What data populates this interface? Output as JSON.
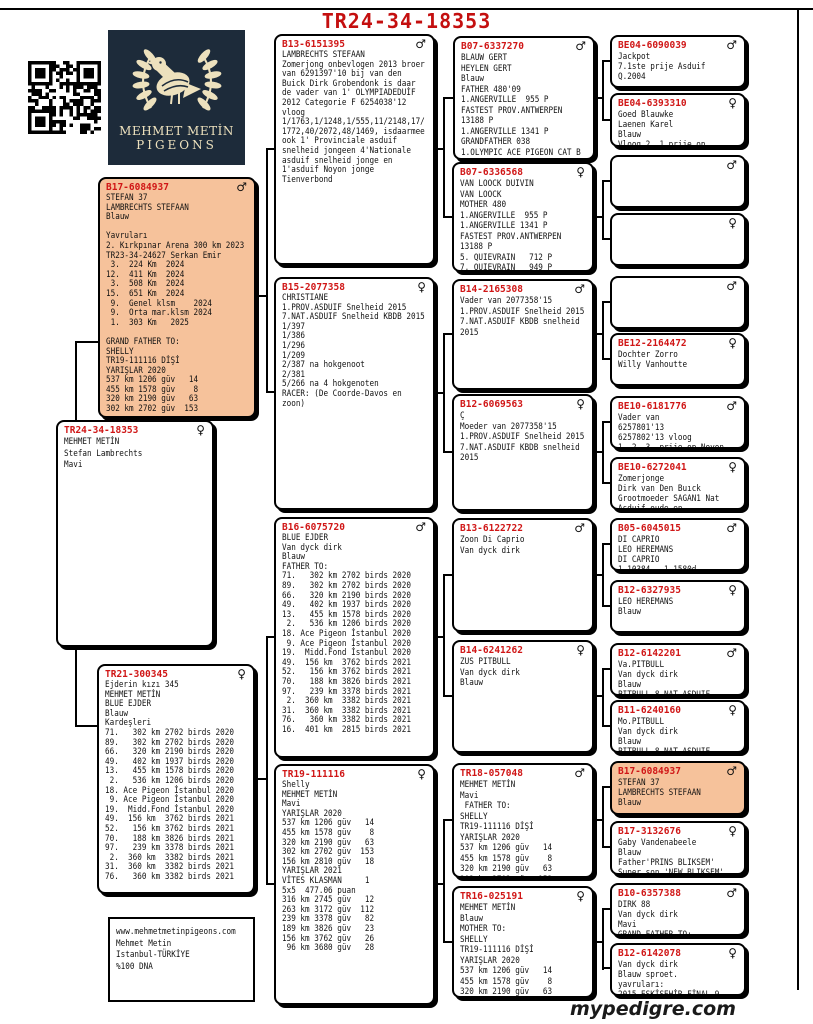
{
  "title": "TR24-34-18353",
  "footer": "mypedigre.com",
  "logo": {
    "name_line1": "MEHMET METİN",
    "name_line2": "PIGEONS"
  },
  "colors": {
    "ring_red": "#d01616",
    "title_red": "#c40f0f",
    "highlight_peach": "#f6c29b",
    "logo_navy": "#1d2b3a",
    "logo_cream": "#ede1bd"
  },
  "boxes": {
    "father": {
      "ring": "B17-6084937",
      "sex": "♂",
      "body": "STEFAN 37\nLAMBRECHTS STEFAAN\nBlauw\n\nYavruları\n2. Kırkpınar Arena 300 km 2023\nTR23-34-24627 Serkan Emir\n 3.  224 Km  2024\n12.  411 Km  2024\n 3.  508 Km  2024\n15.  651 Km  2024\n 9.  Genel klsm    2024\n 9.  Orta mar.klsm 2024\n 1.  303 Km   2025\n\nGRAND FATHER TO:\nSHELLY\nTR19-111116 DİŞİ\nYARIŞLAR 2020\n537 km 1206 güv   14\n455 km 1578 güv    8\n320 km 2190 güv   63\n302 km 2702 güv  153"
    },
    "subject": {
      "ring": "TR24-34-18353",
      "sex": "♀",
      "body": "MEHMET METİN\nStefan Lambrechts\nMavi"
    },
    "mother": {
      "ring": "TR21-300345",
      "sex": "♀",
      "body": "Ejderin kızı 345\nMEHMET METİN\nBLUE EJDER\nBlauw\nKardeşleri\n71.   302 km 2702 birds 2020\n89.   302 km 2702 birds 2020\n66.   320 km 2190 birds 2020\n49.   402 km 1937 birds 2020\n13.   455 km 1578 birds 2020\n 2.   536 km 1206 birds 2020\n18. Ace Pigeon İstanbul 2020\n 9. Ace Pigeon İstanbul 2020\n19.  Midd.Fond İstanbul 2020\n49.  156 km  3762 birds 2021\n52.   156 km 3762 birds 2021\n70.   188 km 3826 birds 2021\n97.   239 km 3378 birds 2021\n 2.  360 km  3382 birds 2021\n31.  360 km  3382 birds 2021\n76.   360 km 3382 birds 2021"
    },
    "contact": {
      "body": "www.mehmetmetinpigeons.com\nMehmet Metin\nIstanbul-TÜRKİYE\n%100 DNA"
    },
    "pgf": {
      "ring": "B13-6151395",
      "sex": "♂",
      "body": "LAMBRECHTS STEFAAN\nZomerjong onbevlogen 2013 broer\nvan 6291397'10 bij van den\nBuick Dirk Grobendonk is daar\nde vader van 1' OLYMPIADEDUİF\n2012 Categorie F 6254038'12\nvloog\n1/1763,1/1248,1/555,11/2148,17/\n1772,40/2072,48/1469, isdaarmee\nook 1' Provinciale asduif\nsnelheid jongeen 4'Nationale\nasduif snelheid jonge en\n1'asduif Noyon jonge\nTienverbond"
    },
    "pgm": {
      "ring": "B15-2077358",
      "sex": "♀",
      "body": "CHRISTIANE\n1.PROV.ASDUIF Snelheid 2015\n7.NAT.ASDUIF Snelheid KBDB 2015\n1/397\n1/386\n1/296\n1/209\n2/387 na hokgenoot\n2/381\n5/266 na 4 hokgenoten\nRACER: (De Coorde-Davos en\nzoon)"
    },
    "mgf": {
      "ring": "B16-6075720",
      "sex": "♂",
      "body": "BLUE EJDER\nVan dyck dirk\nBlauw\nFATHER TO:\n71.   302 km 2702 birds 2020\n89.   302 km 2702 birds 2020\n66.   320 km 2190 birds 2020\n49.   402 km 1937 birds 2020\n13.   455 km 1578 birds 2020\n 2.   536 km 1206 birds 2020\n18. Ace Pigeon İstanbul 2020\n 9. Ace Pigeon İstanbul 2020\n19.  Midd.Fond İstanbul 2020\n49.  156 km  3762 birds 2021\n52.   156 km 3762 birds 2021\n70.   188 km 3826 birds 2021\n97.   239 km 3378 birds 2021\n 2.  360 km  3382 birds 2021\n31.  360 km  3382 birds 2021\n76.   360 km 3382 birds 2021\n16.  401 km  2815 birds 2021"
    },
    "mgm": {
      "ring": "TR19-111116",
      "sex": "♀",
      "body": "Shelly\nMEHMET METİN\nMavi\nYARIŞLAR 2020\n537 km 1206 güv   14\n455 km 1578 güv    8\n320 km 2190 güv   63\n302 km 2702 güv  153\n156 km 2810 güv   18\nYARIŞLAR 2021\nVİTES KLASMAN     1\n5x5  477.06 puan\n316 km 2745 güv   12\n263 km 3172 güv  112\n239 km 3378 güv   82\n189 km 3826 güv   23\n156 km 3762 güv   26\n 96 km 3680 güv   28"
    },
    "g1": {
      "ring": "B07-6337270",
      "sex": "♂",
      "body": "BLAUW GERT\nHEYLEN GERT\nBlauw\nFATHER 480'09\n1.ANGERVILLE  955 P\nFASTEST PROV.ANTWERPEN\n13188 P\n1.ANGERVILLE 1341 P\nGRANDFATHER 038\n1.OLYMPIC ACE PIGEON CAT B"
    },
    "g2": {
      "ring": "B07-6336568",
      "sex": "♀",
      "body": "VAN LOOCK DUIVIN\nVAN LOOCK\nMOTHER 480\n1.ANGERVILLE  955 P\n1.ANGERVILLE 1341 P\nFASTEST PROV.ANTWERPEN\n13188 P\n5. QUIEVRAIN   712 P\n7. QUIEVRAIN   949 P\n14. MELUN     1878 P"
    },
    "g3": {
      "ring": "B14-2165308",
      "sex": "♂",
      "body": "Vader van 2077358'15\n1.PROV.ASDUIF Snelheid 2015\n7.NAT.ASDUIF KBDB snelheid\n2015"
    },
    "g4": {
      "ring": "B12-6069563",
      "sex": "♀",
      "body": "Ç\nMoeder van 2077358'15\n1.PROV.ASDUIF Snelheid 2015\n7.NAT.ASDUIF KBDB snelheid\n2015"
    },
    "g5": {
      "ring": "B13-6122722",
      "sex": "♂",
      "body": "Zoon Di Caprio\nVan dyck dirk"
    },
    "g6": {
      "ring": "B14-6241262",
      "sex": "♀",
      "body": "ZUS PITBULL\nVan dyck dirk\nBlauw"
    },
    "g7": {
      "ring": "TR18-057048",
      "sex": "♂",
      "body": "MEHMET METİN\nMavi\n FATHER TO:\nSHELLY\nTR19-111116 DİŞİ\nYARIŞLAR 2020\n537 km 1206 güv   14\n455 km 1578 güv    8\n320 km 2190 güv   63\n302 km 2702 güv  153"
    },
    "g8": {
      "ring": "TR16-025191",
      "sex": "♀",
      "body": "MEHMET METİN\nBlauw\nMOTHER TO:\nSHELLY\nTR19-111116 DİŞİ\nYARIŞLAR 2020\n537 km 1206 güv   14\n455 km 1578 güv    8\n320 km 2190 güv   63\n302 km 2702 güv  153"
    },
    "gg1": {
      "ring": "BE04-6090039",
      "sex": "♂",
      "body": "Jackpot\n7.1ste prije Asduif\nQ.2004"
    },
    "gg2": {
      "ring": "BE04-6393310",
      "sex": "♀",
      "body": "Goed Blauwke\nLaenen Karel\nBlauw\nVloog 2. 1 prije op"
    },
    "gg3": {
      "ring": "",
      "sex": "♂",
      "body": ""
    },
    "gg4": {
      "ring": "",
      "sex": "♀",
      "body": ""
    },
    "gg5": {
      "ring": "",
      "sex": "♂",
      "body": ""
    },
    "gg6": {
      "ring": "BE12-2164472",
      "sex": "♀",
      "body": "Dochter Zorro\nWilly Vanhoutte"
    },
    "gg7": {
      "ring": "BE10-6181776",
      "sex": "♂",
      "body": "Vader van\n6257801'13\n6257802'13 vloog\n1..2..3..prije op Noyon"
    },
    "gg8": {
      "ring": "BE10-6272041",
      "sex": "♀",
      "body": "Zomerjonge\nDirk van Den Buıck\nGrootmoeder SAGAN1 Nat\nAsduif oude en"
    },
    "gg9": {
      "ring": "B05-6045015",
      "sex": "♂",
      "body": "DI CAPRIO\nLEO HEREMANS\nDI CAPRIO\n1.10384 - 1.1580d"
    },
    "gg10": {
      "ring": "B12-6327935",
      "sex": "♀",
      "body": "LEO HEREMANS\nBlauw"
    },
    "gg11": {
      "ring": "B12-6142201",
      "sex": "♂",
      "body": "Va.PITBULL\nVan dyck dirk\nBlauw\nPITBULL 8 NAT ASDUIF"
    },
    "gg12": {
      "ring": "B11-6240160",
      "sex": "♀",
      "body": "Mo.PITBULL\nVan dyck dirk\nBlauw\nPITBULL 8 NAT ASDUIF"
    },
    "gg13": {
      "ring": "B17-6084937",
      "sex": "♂",
      "body": "STEFAN 37\nLAMBRECHTS STEFAAN\nBlauw"
    },
    "gg14": {
      "ring": "B17-3132676",
      "sex": "♀",
      "body": "Gaby Vandenabeele\nBlauw\nFather'PRINS BLIKSEM'\nSuper son 'NEW BLIKSEM'"
    },
    "gg15": {
      "ring": "B10-6357388",
      "sex": "♂",
      "body": "DIRK 88\nVan dyck dirk\nMavi\nGRAND FATHER TO:"
    },
    "gg16": {
      "ring": "B12-6142078",
      "sex": "♀",
      "body": "Van dyck dirk\nBlauw sproet.\nyavruları:\n2015 ESKİŞEHİR FİNAL 9."
    }
  }
}
